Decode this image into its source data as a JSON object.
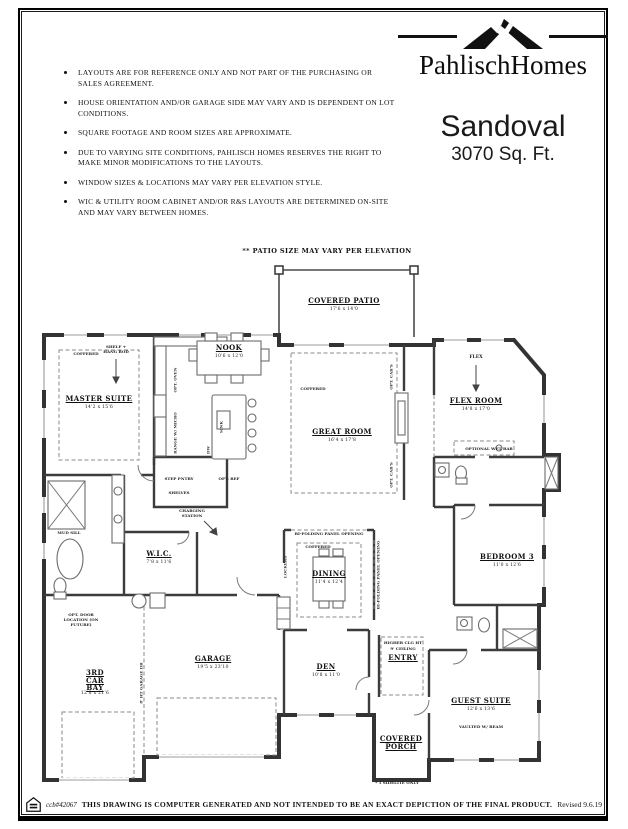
{
  "header": {
    "disclaimers": [
      "LAYOUTS ARE FOR REFERENCE ONLY AND NOT PART OF THE PURCHASING OR SALES AGREEMENT.",
      "HOUSE ORIENTATION AND/OR GARAGE SIDE MAY VARY AND IS DEPENDENT ON LOT CONDITIONS.",
      "SQUARE FOOTAGE AND ROOM SIZES ARE APPROXIMATE.",
      "DUE TO VARYING SITE CONDITIONS, PAHLISCH HOMES RESERVES THE RIGHT TO MAKE MINOR MODIFICATIONS TO THE LAYOUTS.",
      "WINDOW SIZES & LOCATIONS MAY VARY PER ELEVATION STYLE.",
      "WIC & UTILITY ROOM CABINET AND/OR R&S LAYOUTS ARE DETERMINED ON-SITE AND MAY VARY BETWEEN HOMES."
    ]
  },
  "logo": {
    "brand": "PahlischHomes"
  },
  "plan_title": {
    "name": "Sandoval",
    "size": "3070 Sq. Ft."
  },
  "plan": {
    "patio_note": "** PATIO SIZE MAY VARY PER ELEVATION",
    "rooms": {
      "covered_patio": {
        "name": "COVERED PATIO",
        "dims": "17'6 x 14'0"
      },
      "nook": {
        "name": "NOOK",
        "dims": "10'6 x 12'0"
      },
      "master_suite": {
        "name": "MASTER SUITE",
        "dims": "14'2 x 15'6"
      },
      "great_room": {
        "name": "GREAT ROOM",
        "dims": "16'4 x 17'8"
      },
      "flex_room": {
        "name": "FLEX ROOM",
        "dims": "14'8 x 17'0"
      },
      "bedroom3": {
        "name": "BEDROOM 3",
        "dims": "11'0 x 12'6"
      },
      "wic": {
        "name": "W.I.C.",
        "dims": "7'8 x 11'6"
      },
      "dining": {
        "name": "DINING",
        "dims": "11'4 x 12'4"
      },
      "den": {
        "name": "DEN",
        "dims": "10'8 x 11'0"
      },
      "entry": {
        "name": "ENTRY"
      },
      "garage": {
        "name": "GARAGE",
        "dims": "19'5 x 23'10"
      },
      "third_car_bay": {
        "name": "3RD CAR BAY",
        "dims": "12'8 x 21'6"
      },
      "covered_porch": {
        "name": "COVERED PORCH"
      },
      "guest_suite": {
        "name": "GUEST SUITE",
        "dims": "12'6 x 13'6"
      }
    },
    "annotations": {
      "coffered": "COFFERED",
      "shelf_rod": "SHELF + HANG ROD",
      "flex_tag": "FLEX",
      "wet_bar": "OPTIONAL WET BAR",
      "charging": "CHARGING STATION",
      "shelves": "SHELVES",
      "step_pantry": "STEP PNTRY",
      "opt_ref": "OPT. REF",
      "opt_oven": "OPT. OVEN",
      "range_micro": "RANGE W/ MICRO",
      "sink": "SINK",
      "dw": "DW",
      "mud_sill": "MUD SILL",
      "opt_cabs": "OPT. CAB'S",
      "lockers": "LOCKERS",
      "bifold": "BI-FOLDING PANEL OPENING",
      "entry_note1": "HIGHER CLG HT",
      "entry_note2": "9' CEILING",
      "vaulted": "VAULTED W/ BEAM",
      "sidelite": "* 1 SIDELITE ONLY",
      "opt_door": "OPT. DOOR LOCATION (ON FUTURE)",
      "garage_door": "8' HT GARAGE DR"
    }
  },
  "footer": {
    "license": "ccb#42067",
    "note": "THIS DRAWING IS COMPUTER GENERATED AND NOT INTENDED TO BE AN EXACT DEPICTION OF THE FINAL PRODUCT.",
    "revised": "Revised 9.6.19"
  }
}
